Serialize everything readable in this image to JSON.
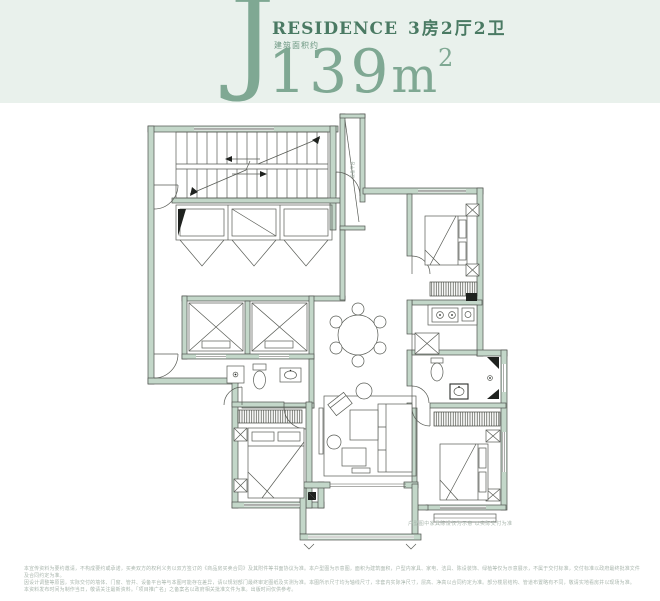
{
  "header": {
    "unit_letter": "J",
    "residence_label": "RESIDENCE",
    "layout_label": "3房2厅2卫",
    "area_prefix_label": "建筑面积约",
    "area_number": "139",
    "area_unit": "m",
    "area_exponent": "2"
  },
  "plan": {
    "shaft_label": "设备平台",
    "caption": "户型图中家具陈设仅为示意 以实际交付为准"
  },
  "footer": {
    "line1": "本宣传资料为要约邀请，不构成要约或承诺，买卖双方的权利义务以双方签订的《商品房买卖合同》及其附件等书面协议为准。本户型图为示意图，面积为建筑面积，户型内家具、家电、洁具、陈设装饰、绿植等仅为示意展示，不属于交付标准，交付标准以政府最终批准文件及合同约定为准。",
    "line2": "因设计调整等原因，实际交付的墙体、门窗、管井、设备平台等与本图可能存在差异，请以规划部门最终审定图纸及实测为准。本图所示尺寸均为轴线尺寸，非套内实际净尺寸，层高、净高以合同约定为准。部分楼层结构、管道布置略有不同，敬请实地看房并以现场为准。",
    "line3": "本资料发布时间为制作当日，敬请关注最新资料。「项目推广名」之备案名以政府相关批准文件为准。出版时间仅供参考。"
  },
  "colors": {
    "header_bg": "#e9f1ec",
    "accent_green": "#7fa893",
    "deep_green": "#4a7a63",
    "area_prefix_green": "#6c9681",
    "wall_fill": "#c3d7c9",
    "wall_stroke": "#4f534e",
    "line_color": "#585b55",
    "tiny_text": "#a9b6ad",
    "page_bg": "#ffffff"
  }
}
